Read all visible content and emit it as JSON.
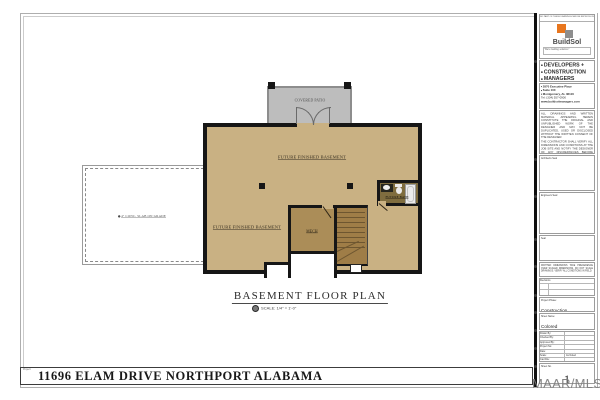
{
  "sheet": {
    "project_bar": {
      "label": "Project:",
      "title": "11696 ELAM DRIVE NORTHPORT ALABAMA"
    },
    "watermark": "MAAR/MLS"
  },
  "plan": {
    "title": "BASEMENT FLOOR PLAN",
    "scale_note": "SCALE:  1/4\" = 1'-0\"",
    "rooms": {
      "covered_patio": "COVERED PATIO",
      "future_finished_basement_upper": "FUTURE FINISHED BASEMENT",
      "future_finished_basement_lower": "FUTURE FINISHED BASEMENT",
      "mech": "MECH",
      "future_bath": "FUTURE BATH"
    },
    "notes": {
      "slab": "4\" CONC. SLAB ON GRADE"
    },
    "colors": {
      "floor": "#c9b183",
      "mech_floor": "#ab8d58",
      "stair_floor": "#9f7d47",
      "bath_floor": "#7f6d3f",
      "patio": "#bdbdbd",
      "wall": "#161616",
      "logo_orange": "#e8761e",
      "logo_gray": "#8e8e8e"
    }
  },
  "titleblock": {
    "top_note": "NO PART OF THESE DRAWINGS MAY BE REPRODUCED",
    "logo": {
      "name": "BuildSol",
      "tagline": "\"We're building solutions\""
    },
    "company_lines": [
      "DEVELOPERS +",
      "CONSTRUCTION",
      "MANAGERS"
    ],
    "address_lines": [
      "2870 Executive Place",
      "Suite 100",
      "Montgomery, AL 36116",
      "Tel: (334) 557-0900",
      "www.buildsolmanagers.com"
    ],
    "disclaimer_1": "ALL DRAWINGS AND WRITTEN MATERIAL APPEARING HEREIN CONSTITUTE THE ORIGINAL AND UNPUBLISHED WORK OF THE DESIGNER AND MAY NOT BE DUPLICATED, USED OR DISCLOSED WITHOUT THE WRITTEN CONSENT OF THE DESIGNER.",
    "disclaimer_2": "THE CONTRACTOR SHALL VERIFY ALL DIMENSIONS AND CONDITIONS AT THE JOB SITE AND NOTIFY THE DESIGNER OF ANY DISCREPANCIES BEFORE PROCEEDING WITH THE WORK.",
    "seal_boxes": [
      "Architects Seal",
      "Engineers Seal",
      "Seal"
    ],
    "notes_block": "WRITTEN DIMENSIONS TAKE PRECEDENCE OVER SCALED DIMENSIONS. DO NOT SCALE DRAWINGS. VERIFY ALL CONDITIONS IN FIELD.",
    "revisions_label": "Revisions",
    "phase": {
      "label": "Project Phase:",
      "value": "Construction Documents"
    },
    "sheet_name": {
      "label": "Sheet Name:",
      "value": "Colored Floor Plan"
    },
    "fields": [
      {
        "label": "Drawn By:",
        "value": ""
      },
      {
        "label": "Checked By:",
        "value": ""
      },
      {
        "label": "Approved By:",
        "value": ""
      },
      {
        "label": "Project No:",
        "value": ""
      },
      {
        "label": "Date:",
        "value": ""
      },
      {
        "label": "Scale:",
        "value": "As Noted"
      },
      {
        "label": "Cad File:",
        "value": ""
      }
    ],
    "sheet_no": {
      "label": "Sheet No.",
      "value": "1"
    }
  }
}
